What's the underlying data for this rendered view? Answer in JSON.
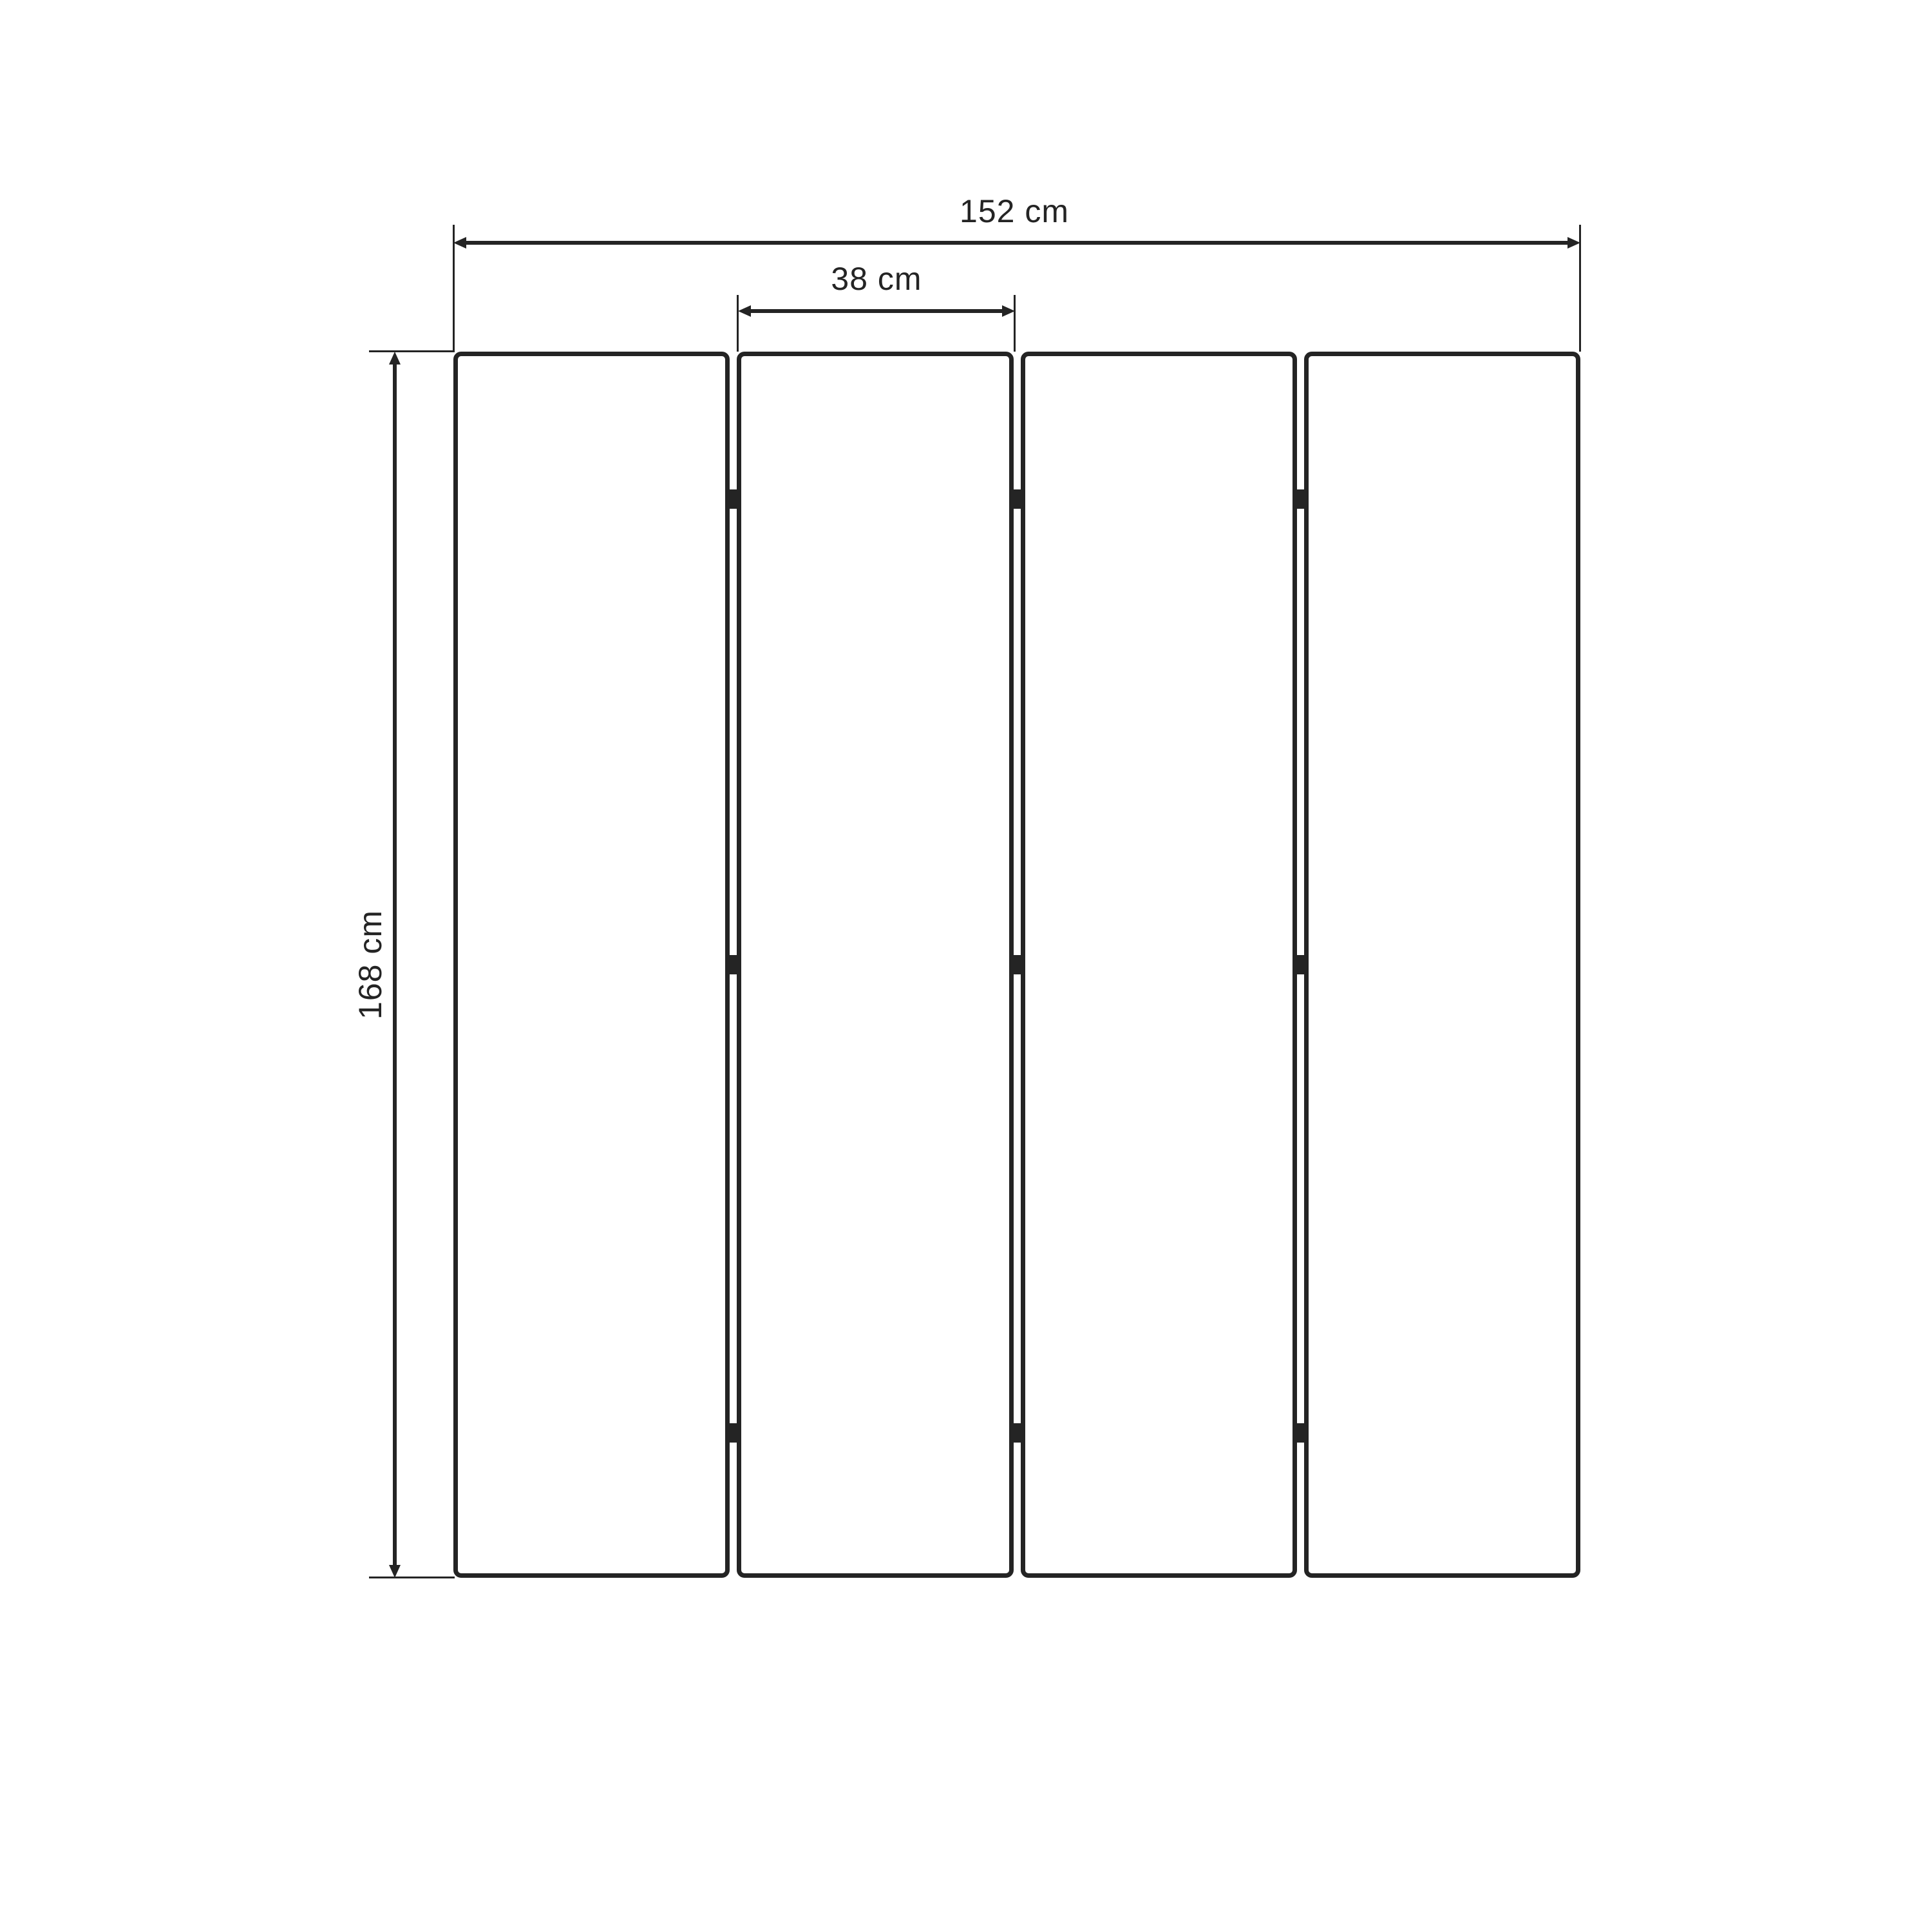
{
  "diagram": {
    "kind": "folding-screen-dimension-drawing",
    "background_color": "#ffffff",
    "line_color": "#242424",
    "panel_count": 4,
    "hinge_rows": 3,
    "labels": {
      "total_width": "152 cm",
      "panel_width": "38 cm",
      "height": "168 cm"
    }
  }
}
